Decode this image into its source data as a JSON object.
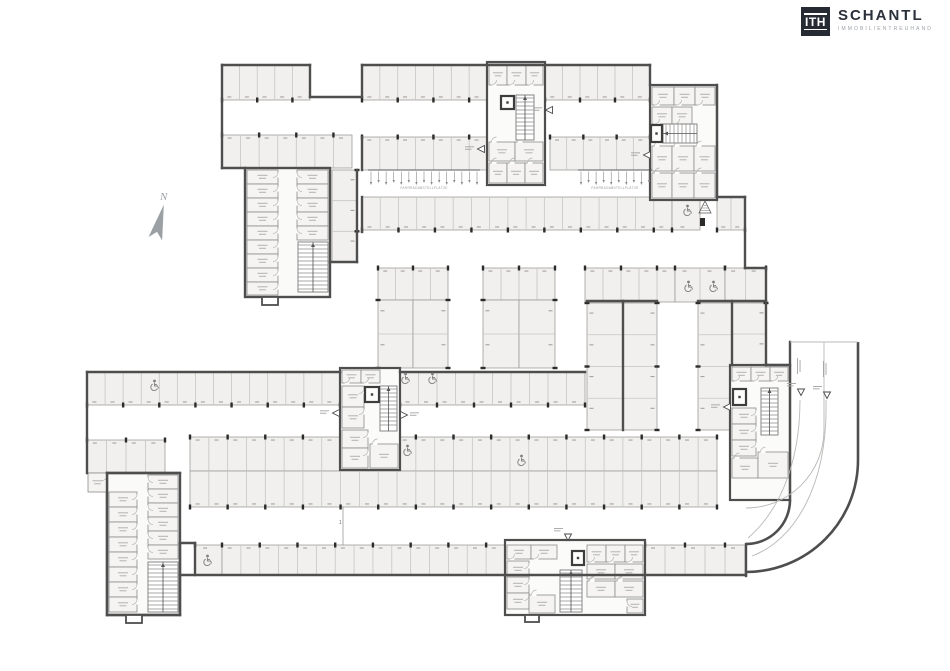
{
  "logo": {
    "mark": "ITH",
    "name": "SCHANTL",
    "tagline": "IMMOBILIENTREUHAND",
    "bg": "#262b33",
    "name_color": "#2b313a",
    "tagline_color": "#9aa0a6"
  },
  "compass": {
    "label": "N"
  },
  "plan": {
    "canvas": {
      "w": 950,
      "h": 671
    },
    "colors": {
      "wall": "#4e4e4e",
      "stall_fill": "#f1f0ee",
      "divider": "#c6c5c3",
      "pillar": "#2b2b2b",
      "icon_gray": "#7f7f7f",
      "background": "#ffffff"
    },
    "bike_label": "FAHRRADABSTELLPLÄTZE",
    "aisle_marker": "1",
    "rows": [
      {
        "x": 222,
        "y": 65,
        "w": 88,
        "h": 35,
        "n": 5,
        "face": "down"
      },
      {
        "x": 362,
        "y": 65,
        "w": 125,
        "h": 35,
        "n": 7,
        "face": "down"
      },
      {
        "x": 545,
        "y": 65,
        "w": 105,
        "h": 35,
        "n": 6,
        "face": "down"
      },
      {
        "x": 222,
        "y": 135,
        "w": 130,
        "h": 33,
        "n": 7,
        "face": "up"
      },
      {
        "x": 362,
        "y": 137,
        "w": 125,
        "h": 33,
        "n": 7,
        "face": "up"
      },
      {
        "x": 550,
        "y": 137,
        "w": 100,
        "h": 33,
        "n": 6,
        "face": "up"
      },
      {
        "x": 717,
        "y": 197,
        "w": 28,
        "h": 33,
        "n": 2,
        "face": "down"
      },
      {
        "x": 362,
        "y": 197,
        "w": 310,
        "h": 33,
        "n": 17,
        "face": "down"
      },
      {
        "x": 672,
        "y": 197,
        "w": 28,
        "h": 33,
        "n": 1,
        "face": "down"
      },
      {
        "x": 585,
        "y": 268,
        "w": 90,
        "h": 34,
        "n": 5,
        "face": "up"
      },
      {
        "x": 675,
        "y": 268,
        "w": 50,
        "h": 34,
        "n": 2,
        "face": "up"
      },
      {
        "x": 725,
        "y": 268,
        "w": 41,
        "h": 34,
        "n": 2,
        "face": "up"
      },
      {
        "x": 378,
        "y": 268,
        "w": 70,
        "h": 32,
        "n": 4,
        "face": "up"
      },
      {
        "x": 378,
        "y": 300,
        "w": 35,
        "h": 68,
        "n": 2,
        "face": "left"
      },
      {
        "x": 413,
        "y": 300,
        "w": 35,
        "h": 68,
        "n": 2,
        "face": "right"
      },
      {
        "x": 483,
        "y": 268,
        "w": 72,
        "h": 32,
        "n": 4,
        "face": "up"
      },
      {
        "x": 483,
        "y": 300,
        "w": 36,
        "h": 68,
        "n": 2,
        "face": "left"
      },
      {
        "x": 519,
        "y": 300,
        "w": 36,
        "h": 68,
        "n": 2,
        "face": "right"
      },
      {
        "x": 587,
        "y": 303,
        "w": 36,
        "h": 127,
        "n": 4,
        "face": "left"
      },
      {
        "x": 623,
        "y": 303,
        "w": 34,
        "h": 127,
        "n": 4,
        "face": "right"
      },
      {
        "x": 698,
        "y": 303,
        "w": 34,
        "h": 127,
        "n": 4,
        "face": "left"
      },
      {
        "x": 732,
        "y": 303,
        "w": 34,
        "h": 62,
        "n": 2,
        "face": "right"
      },
      {
        "x": 87,
        "y": 372,
        "w": 253,
        "h": 33,
        "n": 14,
        "face": "down"
      },
      {
        "x": 400,
        "y": 372,
        "w": 185,
        "h": 33,
        "n": 10,
        "face": "down"
      },
      {
        "x": 87,
        "y": 440,
        "w": 78,
        "h": 33,
        "n": 4,
        "face": "up"
      },
      {
        "x": 190,
        "y": 437,
        "w": 527,
        "h": 34,
        "n": 28,
        "face": "up"
      },
      {
        "x": 190,
        "y": 471,
        "w": 527,
        "h": 36,
        "n": 28,
        "face": "down"
      },
      {
        "x": 195,
        "y": 545,
        "w": 27,
        "h": 30,
        "n": 1,
        "face": "up"
      },
      {
        "x": 222,
        "y": 545,
        "w": 283,
        "h": 30,
        "n": 15,
        "face": "up"
      },
      {
        "x": 645,
        "y": 545,
        "w": 100,
        "h": 30,
        "n": 5,
        "face": "up"
      },
      {
        "x": 332,
        "y": 170,
        "w": 25,
        "h": 92,
        "n": 3,
        "face": "right"
      }
    ],
    "walls": [
      [
        222,
        65,
        310,
        65
      ],
      [
        310,
        65,
        310,
        97
      ],
      [
        310,
        97,
        362,
        97
      ],
      [
        362,
        65,
        362,
        97
      ],
      [
        362,
        65,
        650,
        65
      ],
      [
        650,
        65,
        650,
        85
      ],
      [
        222,
        65,
        222,
        168
      ],
      [
        222,
        168,
        245,
        168
      ],
      [
        87,
        372,
        87,
        473
      ],
      [
        87,
        372,
        340,
        372
      ],
      [
        400,
        372,
        585,
        372
      ],
      [
        745,
        197,
        745,
        268
      ],
      [
        745,
        268,
        766,
        268
      ],
      [
        766,
        268,
        766,
        365
      ],
      [
        766,
        365,
        790,
        365
      ],
      [
        790,
        342,
        790,
        500
      ],
      [
        746,
        544,
        746,
        576
      ],
      [
        180,
        575,
        746,
        575
      ],
      [
        180,
        543,
        180,
        615
      ],
      [
        180,
        543,
        195,
        543
      ],
      [
        195,
        543,
        195,
        575
      ],
      [
        107,
        473,
        107,
        615
      ],
      [
        107,
        615,
        180,
        615
      ],
      [
        107,
        473,
        180,
        473
      ],
      [
        357,
        170,
        357,
        262
      ],
      [
        330,
        262,
        357,
        262
      ],
      [
        362,
        137,
        362,
        170
      ],
      [
        362,
        197,
        362,
        232
      ],
      [
        623,
        301,
        623,
        430
      ],
      [
        587,
        301,
        657,
        301
      ],
      [
        698,
        301,
        766,
        301
      ],
      [
        732,
        301,
        732,
        365
      ],
      [
        717,
        85,
        717,
        197
      ],
      [
        717,
        197,
        745,
        197
      ]
    ],
    "wall_paths": [
      "M858,342 V460 A112,112 0 0 1 746,572",
      "M790,500 A44,44 0 0 1 746,544"
    ],
    "thin_paths": [
      "M824,342 V430 A78,78 0 0 1 746,508",
      "M800,400 C800,470 775,515 748,538",
      "M826,400 C828,485 795,540 752,556",
      "M790,342 H858"
    ],
    "cores": [
      {
        "x": 487,
        "y": 62,
        "w": 58,
        "h": 123
      },
      {
        "x": 650,
        "y": 85,
        "w": 67,
        "h": 115
      },
      {
        "x": 340,
        "y": 368,
        "w": 60,
        "h": 102
      },
      {
        "x": 730,
        "y": 365,
        "w": 60,
        "h": 135
      },
      {
        "x": 505,
        "y": 540,
        "w": 140,
        "h": 75
      }
    ],
    "blocks": [
      {
        "x": 245,
        "y": 168,
        "w": 85,
        "h": 129
      },
      {
        "x": 107,
        "y": 473,
        "w": 73,
        "h": 142
      }
    ],
    "rooms": [
      [
        247,
        170,
        31,
        14,
        "E"
      ],
      [
        247,
        184,
        31,
        14,
        "E"
      ],
      [
        247,
        198,
        31,
        14,
        "E"
      ],
      [
        247,
        212,
        31,
        14,
        "E"
      ],
      [
        247,
        226,
        31,
        14,
        "E"
      ],
      [
        247,
        240,
        31,
        14,
        "E"
      ],
      [
        247,
        254,
        31,
        14,
        "E"
      ],
      [
        247,
        268,
        31,
        14,
        "E"
      ],
      [
        247,
        282,
        31,
        13,
        "E"
      ],
      [
        297,
        170,
        31,
        14,
        "W"
      ],
      [
        297,
        184,
        31,
        14,
        "W"
      ],
      [
        297,
        198,
        31,
        14,
        "W"
      ],
      [
        297,
        212,
        31,
        14,
        "W"
      ],
      [
        297,
        226,
        31,
        14,
        "W"
      ],
      [
        109,
        492,
        28,
        15,
        "E"
      ],
      [
        109,
        507,
        28,
        15,
        "E"
      ],
      [
        109,
        522,
        28,
        15,
        "E"
      ],
      [
        109,
        537,
        28,
        15,
        "E"
      ],
      [
        109,
        552,
        28,
        15,
        "E"
      ],
      [
        109,
        567,
        28,
        15,
        "E"
      ],
      [
        109,
        582,
        28,
        15,
        "E"
      ],
      [
        109,
        597,
        28,
        15,
        "E"
      ],
      [
        148,
        475,
        30,
        14,
        "W"
      ],
      [
        148,
        489,
        30,
        14,
        "W"
      ],
      [
        148,
        503,
        30,
        14,
        "W"
      ],
      [
        148,
        517,
        30,
        14,
        "W"
      ],
      [
        148,
        531,
        30,
        14,
        "W"
      ],
      [
        148,
        545,
        30,
        14,
        "W"
      ],
      [
        88,
        473,
        19,
        19,
        "E"
      ],
      [
        489,
        64,
        18,
        21,
        "S"
      ],
      [
        507,
        64,
        19,
        21,
        "S"
      ],
      [
        526,
        64,
        17,
        21,
        "S"
      ],
      [
        489,
        142,
        26,
        19,
        "N"
      ],
      [
        515,
        142,
        28,
        19,
        "N"
      ],
      [
        489,
        163,
        18,
        20,
        "N"
      ],
      [
        507,
        163,
        18,
        20,
        "N"
      ],
      [
        525,
        163,
        18,
        20,
        "N"
      ],
      [
        652,
        87,
        22,
        18,
        "S"
      ],
      [
        674,
        87,
        21,
        18,
        "S"
      ],
      [
        695,
        87,
        20,
        18,
        "S"
      ],
      [
        652,
        107,
        20,
        17,
        "S"
      ],
      [
        672,
        107,
        20,
        17,
        "S"
      ],
      [
        652,
        146,
        20,
        25,
        "N"
      ],
      [
        672,
        146,
        22,
        25,
        "N"
      ],
      [
        694,
        146,
        21,
        25,
        "N"
      ],
      [
        652,
        173,
        20,
        25,
        "N"
      ],
      [
        672,
        173,
        22,
        25,
        "N"
      ],
      [
        694,
        173,
        21,
        25,
        "N"
      ],
      [
        342,
        370,
        19,
        13,
        "S"
      ],
      [
        361,
        370,
        19,
        13,
        "S"
      ],
      [
        342,
        386,
        22,
        21,
        "E"
      ],
      [
        342,
        407,
        22,
        21,
        "E"
      ],
      [
        342,
        430,
        26,
        18,
        "E"
      ],
      [
        342,
        448,
        26,
        20,
        "E"
      ],
      [
        370,
        444,
        28,
        24,
        "N"
      ],
      [
        732,
        367,
        19,
        14,
        "S"
      ],
      [
        751,
        367,
        19,
        14,
        "S"
      ],
      [
        770,
        367,
        18,
        14,
        "S"
      ],
      [
        732,
        408,
        24,
        16,
        "E"
      ],
      [
        732,
        424,
        24,
        16,
        "E"
      ],
      [
        732,
        440,
        24,
        16,
        "E"
      ],
      [
        732,
        458,
        26,
        20,
        "N"
      ],
      [
        758,
        452,
        30,
        26,
        "N"
      ],
      [
        507,
        545,
        24,
        14,
        "S"
      ],
      [
        531,
        545,
        26,
        14,
        "S"
      ],
      [
        507,
        561,
        22,
        16,
        "E"
      ],
      [
        507,
        577,
        22,
        16,
        "E"
      ],
      [
        507,
        593,
        22,
        16,
        "E"
      ],
      [
        529,
        595,
        26,
        18,
        "N"
      ],
      [
        587,
        545,
        19,
        17,
        "S"
      ],
      [
        606,
        545,
        19,
        17,
        "S"
      ],
      [
        625,
        545,
        18,
        17,
        "S"
      ],
      [
        587,
        564,
        28,
        15,
        "S"
      ],
      [
        615,
        564,
        28,
        15,
        "S"
      ],
      [
        587,
        581,
        28,
        16,
        "N"
      ],
      [
        615,
        581,
        28,
        16,
        "N"
      ],
      [
        627,
        599,
        16,
        14,
        "W"
      ]
    ],
    "stairs": [
      {
        "x": 298,
        "y": 242,
        "w": 30,
        "h": 50,
        "dir": "v"
      },
      {
        "x": 148,
        "y": 562,
        "w": 30,
        "h": 50,
        "dir": "v"
      },
      {
        "x": 516,
        "y": 95,
        "w": 18,
        "h": 45,
        "dir": "v"
      },
      {
        "x": 663,
        "y": 124,
        "w": 34,
        "h": 19,
        "dir": "h"
      },
      {
        "x": 380,
        "y": 386,
        "w": 17,
        "h": 45,
        "dir": "v"
      },
      {
        "x": 761,
        "y": 388,
        "w": 17,
        "h": 47,
        "dir": "v"
      },
      {
        "x": 560,
        "y": 570,
        "w": 22,
        "h": 42,
        "dir": "v"
      }
    ],
    "lifts": [
      [
        501,
        96,
        13,
        13
      ],
      [
        651,
        125,
        11,
        17
      ],
      [
        365,
        387,
        14,
        15
      ],
      [
        733,
        389,
        13,
        16
      ],
      [
        572,
        551,
        12,
        14
      ]
    ],
    "handicap": [
      [
        153,
        385
      ],
      [
        404,
        378
      ],
      [
        431,
        378
      ],
      [
        406,
        450
      ],
      [
        520,
        460
      ],
      [
        686,
        210
      ],
      [
        687,
        286
      ],
      [
        712,
        286
      ],
      [
        206,
        560
      ]
    ],
    "triangles": [
      [
        481,
        149,
        "l"
      ],
      [
        549,
        110,
        "l"
      ],
      [
        647,
        155,
        "l"
      ],
      [
        336,
        413,
        "l"
      ],
      [
        404,
        415,
        "r"
      ],
      [
        727,
        407,
        "l"
      ],
      [
        568,
        537,
        "d"
      ],
      [
        801,
        392,
        "d"
      ],
      [
        827,
        395,
        "d"
      ]
    ],
    "ramp_label_marks": [
      [
        797,
        358
      ],
      [
        823,
        361
      ]
    ],
    "hatch_marker": {
      "x": 699,
      "y": 201,
      "w": 12,
      "h": 12
    },
    "dark_block": [
      700,
      218,
      5,
      8
    ],
    "protrusions": [
      [
        262,
        297,
        16,
        8
      ],
      [
        126,
        615,
        16,
        8
      ],
      [
        525,
        615,
        14,
        7
      ]
    ],
    "bike_rows": [
      {
        "x": 368,
        "y": 170,
        "w": 112
      },
      {
        "x": 578,
        "y": 170,
        "w": 74
      }
    ],
    "aisle_line": {
      "x": 343,
      "y1": 507,
      "y2": 545,
      "lx": 339,
      "ly": 524
    }
  }
}
